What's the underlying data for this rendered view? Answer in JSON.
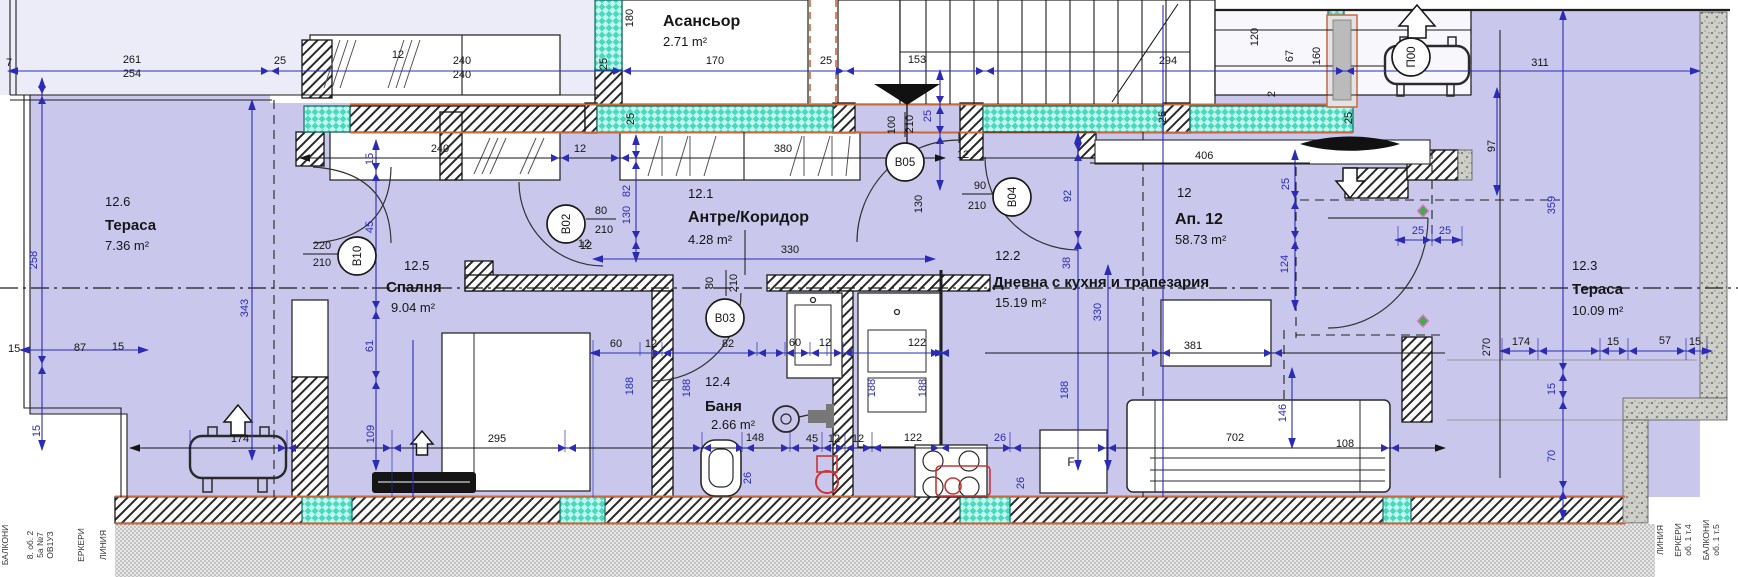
{
  "plan": {
    "apartment_header": {
      "number": "12",
      "name": "Ап. 12",
      "area": "58.73 m²"
    },
    "rooms": [
      {
        "num": "12.6",
        "name": "Тераса",
        "area": "7.36 m²",
        "np": [
          105,
          206
        ],
        "tp": [
          105,
          230
        ],
        "ap": [
          105,
          250
        ],
        "fs": 15
      },
      {
        "num": "12.5",
        "name": "Спалня",
        "area": "9.04 m²",
        "np": [
          404,
          270
        ],
        "tp": [
          386,
          292
        ],
        "ap": [
          391,
          312
        ],
        "fs": 15
      },
      {
        "num": "12.1",
        "name": "Антре/Коридор",
        "area": "4.28 m²",
        "np": [
          688,
          198
        ],
        "tp": [
          688,
          222
        ],
        "ap": [
          688,
          244
        ],
        "fs": 16
      },
      {
        "num": "12.2",
        "name": "Дневна с кухня и трапезария",
        "area": "15.19 m²",
        "np": [
          995,
          260
        ],
        "tp": [
          993,
          287
        ],
        "ap": [
          995,
          307
        ],
        "fs": 15
      },
      {
        "num": "12.4",
        "name": "Баня",
        "area": "2.66 m²",
        "np": [
          705,
          386
        ],
        "tp": [
          705,
          411
        ],
        "ap": [
          711,
          429
        ],
        "fs": 15
      },
      {
        "num": "12.3",
        "name": "Тераса",
        "area": "10.09 m²",
        "np": [
          1572,
          270
        ],
        "tp": [
          1572,
          294
        ],
        "ap": [
          1572,
          315
        ],
        "fs": 15
      },
      {
        "num": "",
        "name": "Асансьор",
        "area": "2.71 m²",
        "np": [
          0,
          0
        ],
        "tp": [
          663,
          26
        ],
        "ap": [
          663,
          46
        ],
        "fs": 16
      },
      {
        "num": "12",
        "name": "Ап. 12",
        "area": "58.73 m²",
        "np": [
          1177,
          197
        ],
        "tp": [
          1175,
          224
        ],
        "ap": [
          1175,
          244
        ],
        "fs": 16
      }
    ],
    "door_tags": [
      {
        "id": "B10",
        "x": 357,
        "y": 256,
        "rot": 1,
        "size": "220/210"
      },
      {
        "id": "B02",
        "x": 566,
        "y": 224,
        "rot": 1,
        "size": "80/210"
      },
      {
        "id": "B03",
        "x": 725,
        "y": 318,
        "rot": 0,
        "size": "80/210"
      },
      {
        "id": "B05",
        "x": 905,
        "y": 162,
        "rot": 0,
        "size": "100/210"
      },
      {
        "id": "B04",
        "x": 1012,
        "y": 197,
        "rot": 1,
        "size": "90/210"
      },
      {
        "id": "П00",
        "x": 1411,
        "y": 57,
        "rot": 1,
        "size": ""
      }
    ],
    "dims": [
      {
        "t": "7",
        "x": 6,
        "y": 66,
        "a": "start"
      },
      {
        "t": "261",
        "x": 132,
        "y": 63
      },
      {
        "t": "254",
        "x": 132,
        "y": 77
      },
      {
        "t": "25",
        "x": 280,
        "y": 64
      },
      {
        "t": "240",
        "x": 462,
        "y": 64
      },
      {
        "t": "240",
        "x": 462,
        "y": 78
      },
      {
        "t": "170",
        "x": 715,
        "y": 64
      },
      {
        "t": "25",
        "x": 826,
        "y": 64
      },
      {
        "t": "153",
        "x": 917,
        "y": 63
      },
      {
        "t": "294",
        "x": 1168,
        "y": 64
      },
      {
        "t": "311",
        "x": 1540,
        "y": 66
      },
      {
        "t": "12",
        "x": 398,
        "y": 58
      },
      {
        "t": "240",
        "x": 440,
        "y": 152
      },
      {
        "t": "12",
        "x": 580,
        "y": 152
      },
      {
        "t": "380",
        "x": 783,
        "y": 152
      },
      {
        "t": "406",
        "x": 1195,
        "y": 159,
        "a": "start"
      },
      {
        "t": "12",
        "x": 963,
        "y": 158
      },
      {
        "t": "330",
        "x": 790,
        "y": 253
      },
      {
        "t": "12",
        "x": 584,
        "y": 247
      },
      {
        "t": "60",
        "x": 616,
        "y": 347
      },
      {
        "t": "12",
        "x": 651,
        "y": 347
      },
      {
        "t": "82",
        "x": 728,
        "y": 347
      },
      {
        "t": "60",
        "x": 795,
        "y": 346
      },
      {
        "t": "12",
        "x": 825,
        "y": 346
      },
      {
        "t": "122",
        "x": 917,
        "y": 346
      },
      {
        "t": "381",
        "x": 1193,
        "y": 349
      },
      {
        "t": "174",
        "x": 240,
        "y": 442
      },
      {
        "t": "295",
        "x": 497,
        "y": 442
      },
      {
        "t": "148",
        "x": 755,
        "y": 441
      },
      {
        "t": "45",
        "x": 812,
        "y": 442
      },
      {
        "t": "12",
        "x": 834,
        "y": 442
      },
      {
        "t": "12",
        "x": 858,
        "y": 442
      },
      {
        "t": "122",
        "x": 913,
        "y": 441
      },
      {
        "t": "26",
        "x": 1000,
        "y": 441,
        "c": "b"
      },
      {
        "t": "702",
        "x": 1235,
        "y": 441
      },
      {
        "t": "108",
        "x": 1345,
        "y": 447
      },
      {
        "t": "25",
        "x": 1418,
        "y": 234,
        "c": "b"
      },
      {
        "t": "25",
        "x": 1445,
        "y": 234,
        "c": "b"
      },
      {
        "t": "174",
        "x": 1521,
        "y": 345
      },
      {
        "t": "15",
        "x": 1613,
        "y": 345
      },
      {
        "t": "57",
        "x": 1665,
        "y": 344
      },
      {
        "t": "15",
        "x": 1695,
        "y": 345
      },
      {
        "t": "15",
        "x": 8,
        "y": 352,
        "a": "start"
      },
      {
        "t": "87",
        "x": 80,
        "y": 351
      },
      {
        "t": "15",
        "x": 118,
        "y": 350
      },
      {
        "t": "F",
        "x": 1071,
        "y": 466,
        "s": 12
      },
      {
        "t": "80",
        "x": 601,
        "y": 214
      },
      {
        "t": "210",
        "x": 604,
        "y": 233
      },
      {
        "t": "12",
        "x": 586,
        "y": 249
      },
      {
        "t": "220",
        "x": 322,
        "y": 249
      },
      {
        "t": "210",
        "x": 322,
        "y": 266
      },
      {
        "t": "90",
        "x": 980,
        "y": 189
      },
      {
        "t": "210",
        "x": 977,
        "y": 209
      },
      {
        "t": "180",
        "x": 633,
        "y": 18,
        "r": 1
      },
      {
        "t": "25",
        "x": 607,
        "y": 64,
        "r": 1
      },
      {
        "t": "25",
        "x": 634,
        "y": 119,
        "r": 1
      },
      {
        "t": "120",
        "x": 1258,
        "y": 37,
        "r": 1
      },
      {
        "t": "67",
        "x": 1293,
        "y": 56,
        "r": 1
      },
      {
        "t": "160",
        "x": 1320,
        "y": 56,
        "r": 1
      },
      {
        "t": "2",
        "x": 1275,
        "y": 94,
        "r": 1
      },
      {
        "t": "25",
        "x": 1166,
        "y": 117,
        "r": 1
      },
      {
        "t": "25",
        "x": 1352,
        "y": 118,
        "r": 1
      },
      {
        "t": "97",
        "x": 1495,
        "y": 146,
        "r": 1
      },
      {
        "t": "359",
        "x": 1555,
        "y": 205,
        "r": 1,
        "c": "b"
      },
      {
        "t": "15",
        "x": 1555,
        "y": 389,
        "r": 1,
        "c": "b"
      },
      {
        "t": "70",
        "x": 1555,
        "y": 456,
        "r": 1,
        "c": "b"
      },
      {
        "t": "258",
        "x": 37,
        "y": 260,
        "r": 1,
        "c": "b"
      },
      {
        "t": "343",
        "x": 248,
        "y": 308,
        "r": 1,
        "c": "b"
      },
      {
        "t": "15",
        "x": 373,
        "y": 159,
        "r": 1,
        "c": "b"
      },
      {
        "t": "45",
        "x": 373,
        "y": 227,
        "r": 1,
        "c": "b"
      },
      {
        "t": "61",
        "x": 373,
        "y": 346,
        "r": 1,
        "c": "b"
      },
      {
        "t": "109",
        "x": 374,
        "y": 434,
        "r": 1,
        "c": "b"
      },
      {
        "t": "15",
        "x": 40,
        "y": 431,
        "r": 1,
        "c": "b"
      },
      {
        "t": "82",
        "x": 630,
        "y": 191,
        "r": 1,
        "c": "b"
      },
      {
        "t": "130",
        "x": 630,
        "y": 215,
        "r": 1,
        "c": "b"
      },
      {
        "t": "100",
        "x": 895,
        "y": 125,
        "r": 1
      },
      {
        "t": "210",
        "x": 913,
        "y": 124,
        "r": 1
      },
      {
        "t": "25",
        "x": 931,
        "y": 116,
        "r": 1,
        "c": "b"
      },
      {
        "t": "130",
        "x": 922,
        "y": 204,
        "r": 1
      },
      {
        "t": "92",
        "x": 1071,
        "y": 196,
        "r": 1,
        "c": "b"
      },
      {
        "t": "38",
        "x": 1070,
        "y": 263,
        "r": 1,
        "c": "b"
      },
      {
        "t": "330",
        "x": 1101,
        "y": 312,
        "r": 1,
        "c": "b"
      },
      {
        "t": "25",
        "x": 1289,
        "y": 184,
        "r": 1,
        "c": "b"
      },
      {
        "t": "124",
        "x": 1288,
        "y": 264,
        "r": 1,
        "c": "b"
      },
      {
        "t": "146",
        "x": 1286,
        "y": 413,
        "r": 1,
        "c": "b"
      },
      {
        "t": "188",
        "x": 633,
        "y": 386,
        "r": 1,
        "c": "b"
      },
      {
        "t": "188",
        "x": 690,
        "y": 388,
        "r": 1,
        "c": "b"
      },
      {
        "t": "188",
        "x": 875,
        "y": 388,
        "r": 1,
        "c": "b"
      },
      {
        "t": "188",
        "x": 926,
        "y": 388,
        "r": 1,
        "c": "b"
      },
      {
        "t": "188",
        "x": 1068,
        "y": 390,
        "r": 1,
        "c": "b"
      },
      {
        "t": "26",
        "x": 751,
        "y": 478,
        "r": 1,
        "c": "b"
      },
      {
        "t": "26",
        "x": 1024,
        "y": 483,
        "r": 1,
        "c": "b"
      },
      {
        "t": "270",
        "x": 1490,
        "y": 347,
        "r": 1
      },
      {
        "t": "210",
        "x": 737,
        "y": 283,
        "r": 1
      },
      {
        "t": "80",
        "x": 713,
        "y": 283,
        "r": 1
      }
    ],
    "legend_left": [
      {
        "t": "БАЛКОНИ",
        "x": 8,
        "y": 545
      },
      {
        "t": "8. об. 2",
        "x": 33,
        "y": 545
      },
      {
        "t": "5а №7",
        "x": 43,
        "y": 545
      },
      {
        "t": "ОВ1УЗ",
        "x": 53,
        "y": 545
      },
      {
        "t": "ЕРКЕРИ",
        "x": 84,
        "y": 545
      },
      {
        "t": "ЛИНИЯ",
        "x": 106,
        "y": 545
      }
    ],
    "legend_right": [
      {
        "t": "ЛИНИЯ",
        "x": 1663,
        "y": 540
      },
      {
        "t": "ЕРКЕРИ",
        "x": 1681,
        "y": 540
      },
      {
        "t": "об. 1 т.4",
        "x": 1691,
        "y": 540
      },
      {
        "t": "БАЛКОНИ",
        "x": 1709,
        "y": 540
      },
      {
        "t": "об. 1 т.5",
        "x": 1719,
        "y": 540
      }
    ],
    "colors": {
      "floor_fill": "#c9c8ec",
      "pale_fill": "#ececf8",
      "teal_wall": "#49d9c0",
      "dim_blue": "#2b2bb8",
      "orange_line": "#c8693c",
      "red_fixture": "#cc3333",
      "text": "#161616"
    }
  }
}
